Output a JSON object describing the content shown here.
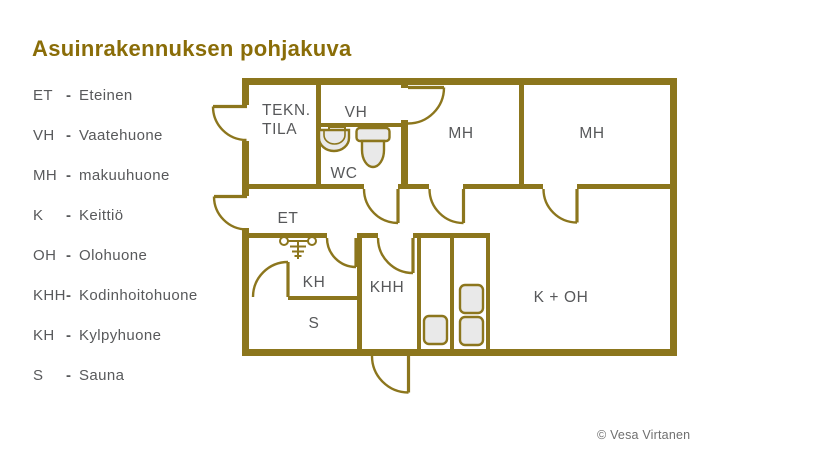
{
  "title": "Asuinrakennuksen pohjakuva",
  "legend": {
    "separator": "-",
    "items": [
      {
        "abbr": "ET",
        "name": "Eteinen"
      },
      {
        "abbr": "VH",
        "name": "Vaatehuone"
      },
      {
        "abbr": "MH",
        "name": "makuuhuone"
      },
      {
        "abbr": "K",
        "name": "Keittiö"
      },
      {
        "abbr": "OH",
        "name": "Olohuone"
      },
      {
        "abbr": "KHH",
        "name": "Kodinhoitohuone"
      },
      {
        "abbr": "KH",
        "name": "Kylpyhuone"
      },
      {
        "abbr": "S",
        "name": "Sauna"
      }
    ]
  },
  "plan": {
    "rooms": {
      "tekn_line1": "TEKN.",
      "tekn_line2": "TILA",
      "vh": "VH",
      "wc": "WC",
      "mh1": "MH",
      "mh2": "MH",
      "et": "ET",
      "kh": "KH",
      "khh": "KHH",
      "s": "S",
      "k_oh": "K + OH"
    }
  },
  "footer": {
    "copyright": "© Vesa Virtanen"
  },
  "colors": {
    "wall": "#8c761d",
    "title": "#8a6d08",
    "room_label": "#57585a",
    "legend_text": "#58595b",
    "fixture_fill": "#e9e9e9"
  }
}
